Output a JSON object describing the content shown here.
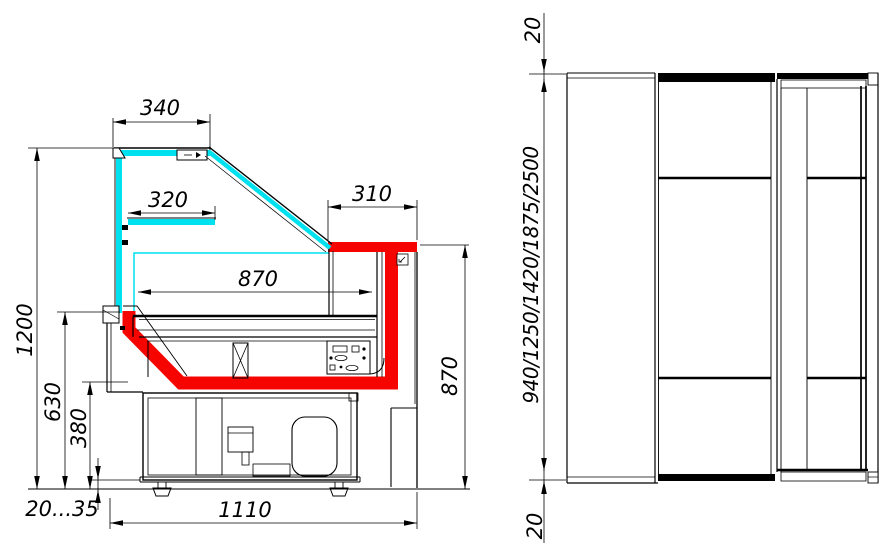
{
  "drawing": {
    "title": "Refrigerated serve-over display counter — side section and front elevation",
    "colors": {
      "glass": "#00e1ef",
      "highlight": "#f60400",
      "line": "#000000",
      "background": "#ffffff"
    },
    "side_view": {
      "dims": {
        "canopy_depth": "340",
        "shelf_depth": "320",
        "worktop_depth": "310",
        "display_depth": "870",
        "overall_height": "1200",
        "deck_height": "630",
        "well_height": "380",
        "foot_adjust": "20...35",
        "base_depth": "1110",
        "rear_height": "870"
      }
    },
    "front_view": {
      "dims": {
        "top_clearance": "20",
        "length_options": "940/1250/1420/1875/2500",
        "bottom_clearance": "20"
      }
    }
  }
}
